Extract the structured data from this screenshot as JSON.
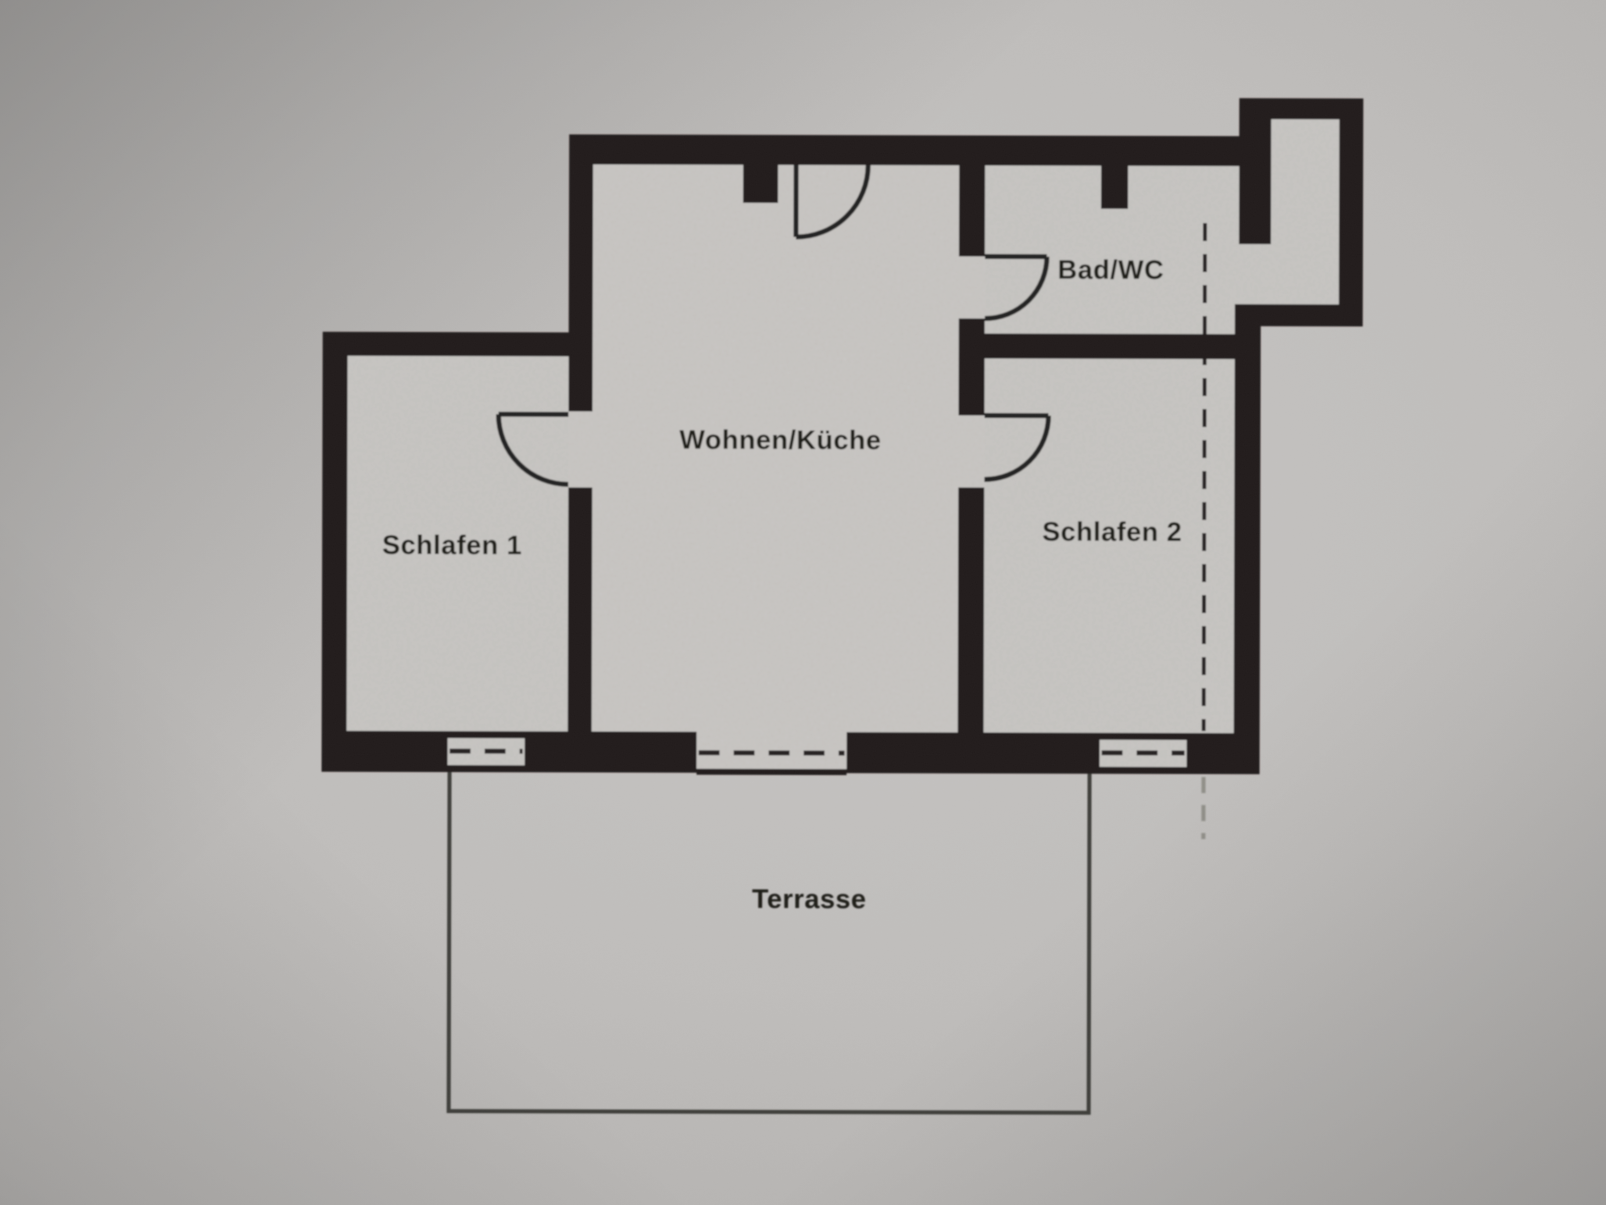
{
  "plan": {
    "rooms": [
      {
        "key": "wohnen_kueche",
        "label": "Wohnen/Küche"
      },
      {
        "key": "schlafen_1",
        "label": "Schlafen 1"
      },
      {
        "key": "schlafen_2",
        "label": "Schlafen 2"
      },
      {
        "key": "bad_wc",
        "label": "Bad/WC"
      },
      {
        "key": "terrasse",
        "label": "Terrasse"
      }
    ],
    "features": {
      "doors": 4,
      "windows": 3
    }
  },
  "colors": {
    "wall": "#211f1c",
    "paper_outer": "#b7b5b3",
    "paper_room": "#c9c7c4",
    "line": "#262421",
    "text": "#1d1b19"
  }
}
